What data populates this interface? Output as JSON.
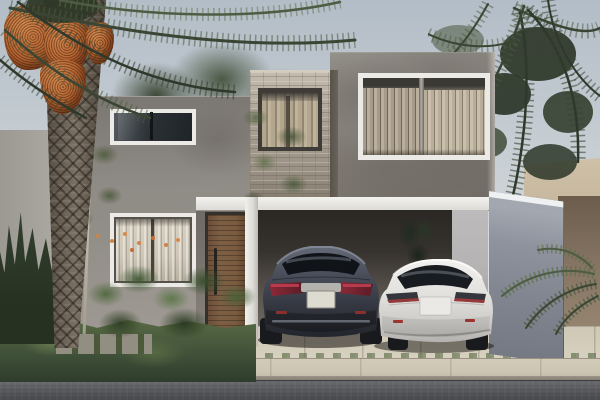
{
  "scene": {
    "type": "architectural-exterior-render",
    "description": "Photorealistic render of a modern two-story house: gray stucco volumes with a stone-clad accent column, white fascia over a carport sheltering a dark gray sedan and a white sedan, wood-slat front door, curtained windows, a date palm with orange fruit clusters, tropical garden, blue-gray privacy wall, concrete driveway, sidewalk and asphalt street.",
    "objects": [
      "sky",
      "background trees",
      "date palm",
      "orange date clusters",
      "single-story left wing",
      "clerestory window",
      "ground-floor curtained window",
      "wood slat front door",
      "stone accent column",
      "stone column window with curtains",
      "second-story volume",
      "large curtained window",
      "white fascia canopy",
      "carport",
      "dark gray sedan (rear view)",
      "white sedan (rear view)",
      "blue-gray privacy wall",
      "beige neighbor wall",
      "tan neighbor wall",
      "concrete driveway with joints",
      "entry walkway",
      "sidewalk",
      "curb",
      "asphalt street",
      "groundcover",
      "shrubs",
      "small trees",
      "palm fronds"
    ]
  },
  "palette": {
    "sky_top": "#b3bdc7",
    "sky_mid": "#c9d0d5",
    "sky_bottom": "#e0e3e4",
    "wall_main": "#87827c",
    "wall_main_dark": "#6f6a64",
    "wall_main_light": "#94908a",
    "wall_left": "#918d87",
    "wall_left_light": "#a29d96",
    "trim_white": "#eceae6",
    "fascia_top": "#f3f2ef",
    "fascia_bottom": "#dcdbd6",
    "stone_light": "#c4bcae",
    "stone_base": "#a89f92",
    "stone_dark": "#837b6e",
    "stone_side": "#57524b",
    "glass_dark": "#1f2428",
    "glass_light": "#555b60",
    "curtain_base": "#a79c8a",
    "curtain_dark": "#6f6759",
    "curtain_light": "#c9bfab",
    "curtain_white": "#cfc8b8",
    "valance": "#3b3934",
    "door_wood": "#7d5f45",
    "door_wood_dark": "#5e4430",
    "door_frame": "#34302c",
    "carport_top": "#2a2724",
    "carport_mid": "#55504a",
    "carport_floor": "#8a857c",
    "inner_wall": "#b5b3b3",
    "privacy_wall": "#8e939d",
    "privacy_wall_dark": "#747983",
    "coping": "#eef0f1",
    "neighbor_beige": "#c6b79e",
    "neighbor_tan_top": "#6b5c4b",
    "neighbor_tan": "#9d8d76",
    "driveway": "#d8d1bf",
    "sidewalk": "#ccc5b3",
    "street": "#5d5e61",
    "street_dark": "#47484b",
    "groundcover": "#41523a",
    "foliage_dark": "#263122",
    "foliage_mid": "#49593c",
    "foliage_bright": "#6c7f52",
    "frond_dark": "#3a4533",
    "frond_mid": "#4d5c42",
    "frond_light": "#5e7149",
    "palm_trunk": "#6e6458",
    "palm_trunk_dark": "#4e463c",
    "dates_orange": "#b4632f",
    "dates_dark": "#8a4d26",
    "flower_orange": "#d08346",
    "car_dark_top": "#666b78",
    "car_dark": "#474b57",
    "car_dark_mid": "#32353e",
    "car_dark_low": "#23252c",
    "car_white": "#f2f1ef",
    "car_white_mid": "#e3e2df",
    "car_white_shade": "#cecdc9",
    "car_white_dark": "#b3b2ae",
    "taillight_red": "#a83a3a",
    "taillight_deep": "#8c2a38",
    "plate": "#dedbd1",
    "chrome": "#b4b2ac",
    "tire": "#191a1d"
  }
}
